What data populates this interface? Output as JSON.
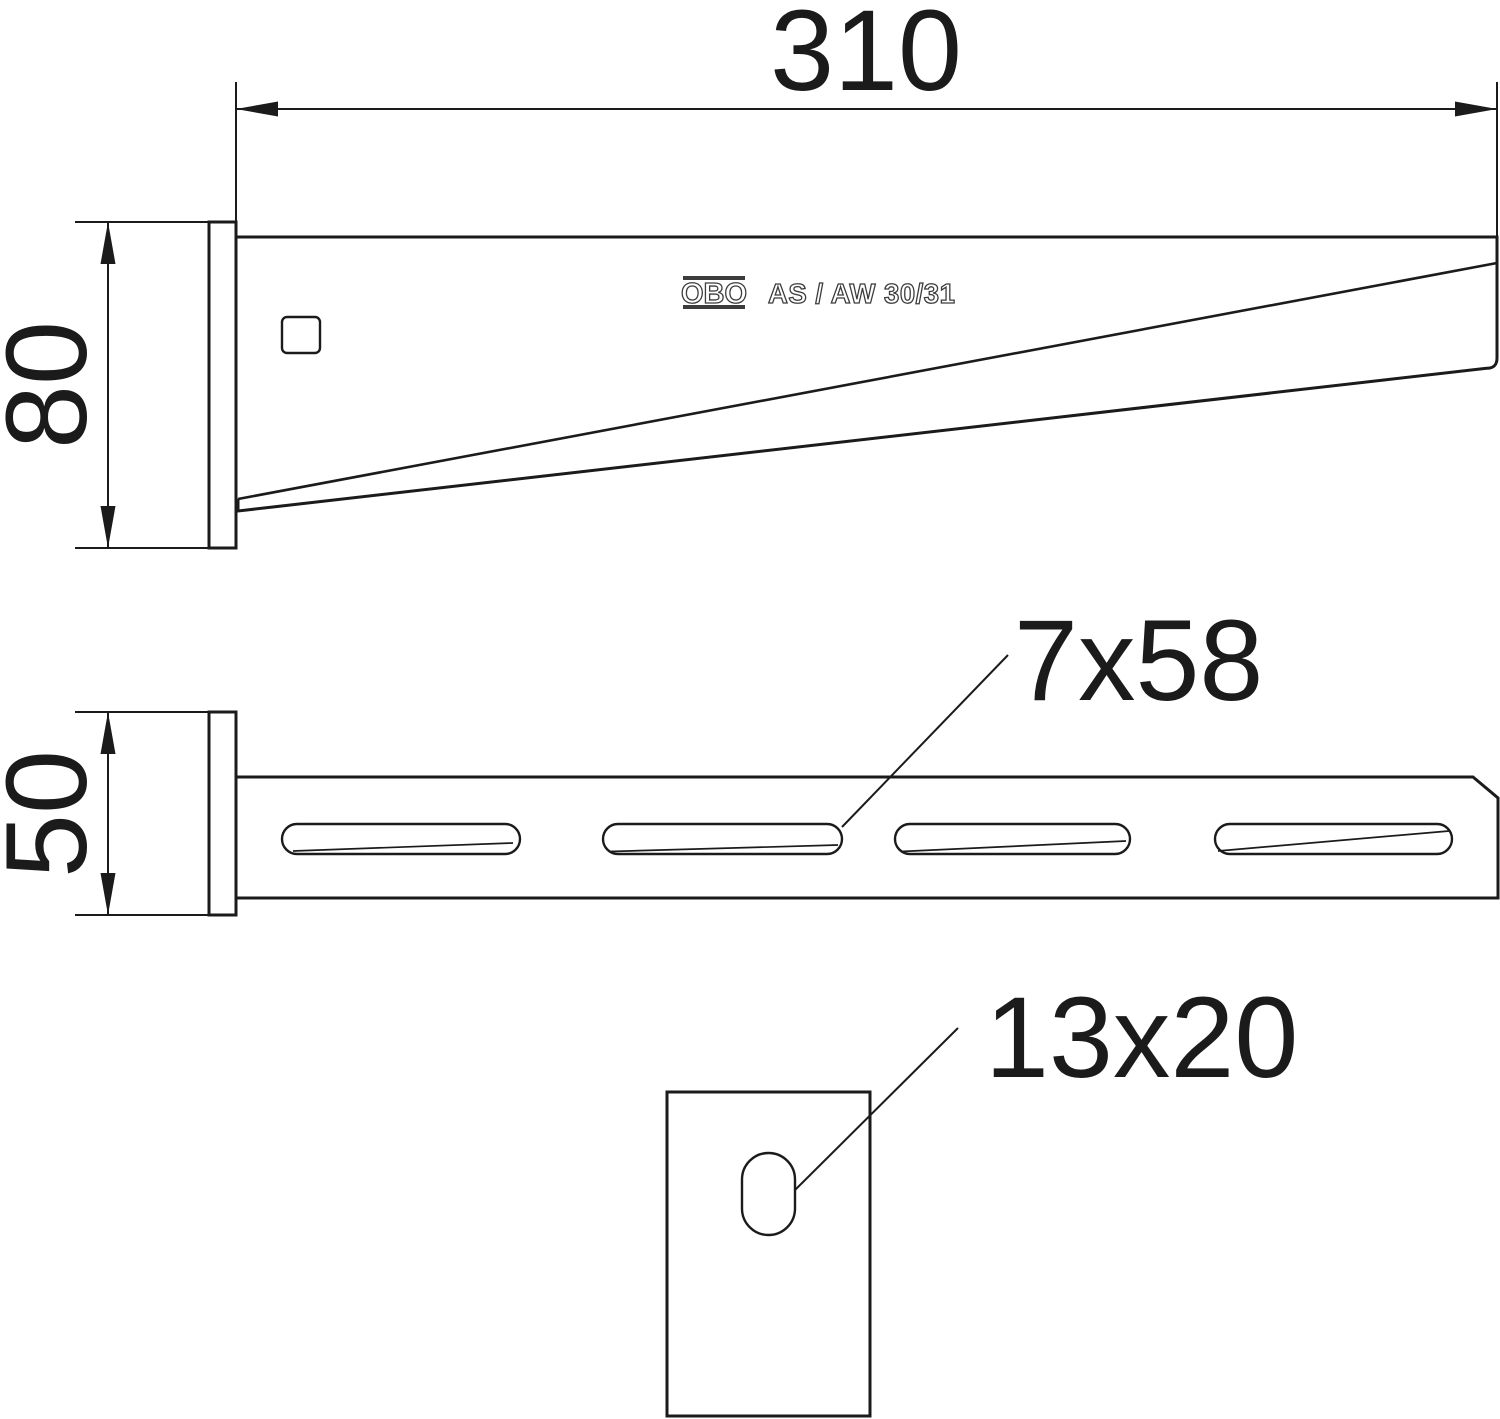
{
  "drawing": {
    "brand": "OBO",
    "product_label": "AS / AW 30/31",
    "dimensions": {
      "length": "310",
      "height": "80",
      "width": "50",
      "slot": "7x58",
      "hole": "13x20"
    },
    "slot_count": 4,
    "colors": {
      "line": "#1b1b1b",
      "background": "#ffffff"
    }
  }
}
